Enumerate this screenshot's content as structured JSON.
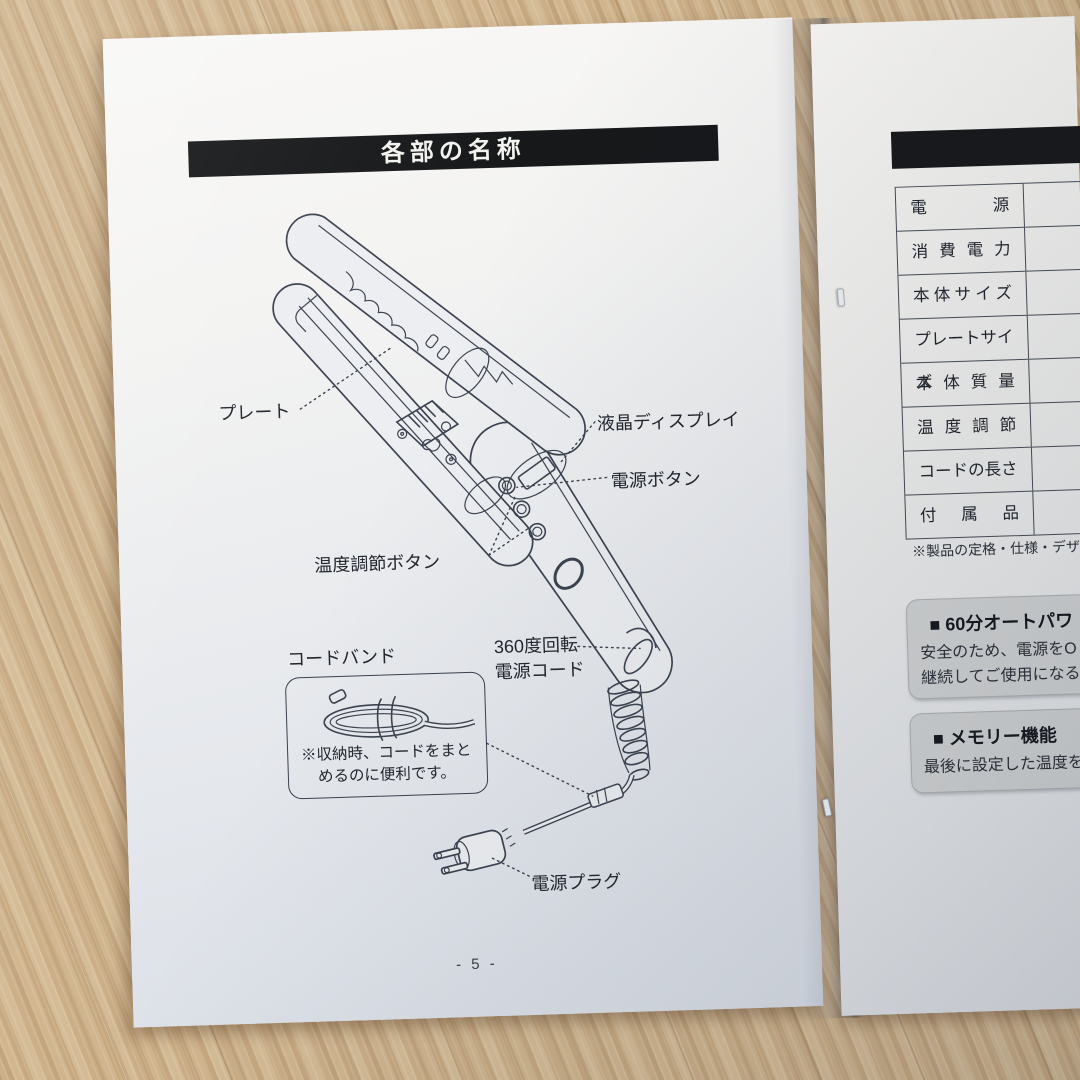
{
  "left_page": {
    "title": "各部の名称",
    "page_number": "- 5 -",
    "labels": {
      "plate": "プレート",
      "lcd_display": "液晶ディスプレイ",
      "power_button": "電源ボタン",
      "temp_button": "温度調節ボタン",
      "cord_band": "コードバンド",
      "swivel_line1": "360度回転",
      "swivel_line2": "電源コード",
      "power_plug": "電源プラグ"
    },
    "cord_band_note": {
      "line1": "※収納時、コードをまと",
      "line2": "めるのに便利です。"
    }
  },
  "right_page": {
    "spec_table": {
      "rows": [
        "電源",
        "消費電力",
        "本体サイズ",
        "プレートサイズ",
        "本体質量",
        "温度調節",
        "コードの長さ",
        "付属品"
      ]
    },
    "table_note": "※製品の定格・仕様・デザイン",
    "sections": [
      {
        "heading": "■ 60分オートパワ",
        "line1": "安全のため、電源をO",
        "line2": "継続してご使用になる"
      },
      {
        "heading": "■ メモリー機能",
        "line1": "最後に設定した温度を",
        "line2": ""
      }
    ]
  },
  "colors": {
    "title_bar_bg": "#17181a",
    "title_text": "#f2f2ef",
    "ink": "#3c4350",
    "gray_box_bg": "#d2d4d4",
    "wood": "#c7aa82"
  }
}
